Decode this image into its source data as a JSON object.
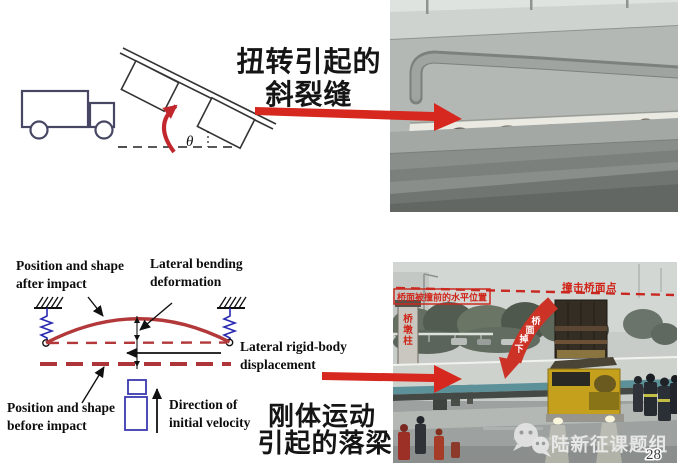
{
  "page": {
    "number": "28",
    "watermark": "陆新征课题组"
  },
  "top": {
    "caption_line1": "扭转引起的",
    "caption_line2": "斜裂缝",
    "theta": "θ"
  },
  "bottom": {
    "caption_line1": "刚体运动",
    "caption_line2": "引起的落梁",
    "labels": {
      "after1": "Position and shape",
      "after2": "after impact",
      "bend1": "Lateral bending",
      "bend2": "deformation",
      "rigid1": "Lateral rigid-body",
      "rigid2": "displacement",
      "before1": "Position and shape",
      "before2": "before impact",
      "vel1": "Direction of",
      "vel2": "initial velocity"
    }
  },
  "photo_annotations": {
    "impact_point": "撞击桥面点",
    "deck_before_position": "桥面被撞前的水平位置",
    "pier_char1": "桥",
    "pier_char2": "墩",
    "pier_char3": "柱",
    "fall_char1": "桥",
    "fall_char2": "面",
    "fall_char3": "掉",
    "fall_char4": "下"
  },
  "colors": {
    "arrow_red": "#d6281e",
    "diagram_red": "#b2383a",
    "annotation_red": "#cc2a20",
    "spring_blue": "#2a2ab0"
  }
}
